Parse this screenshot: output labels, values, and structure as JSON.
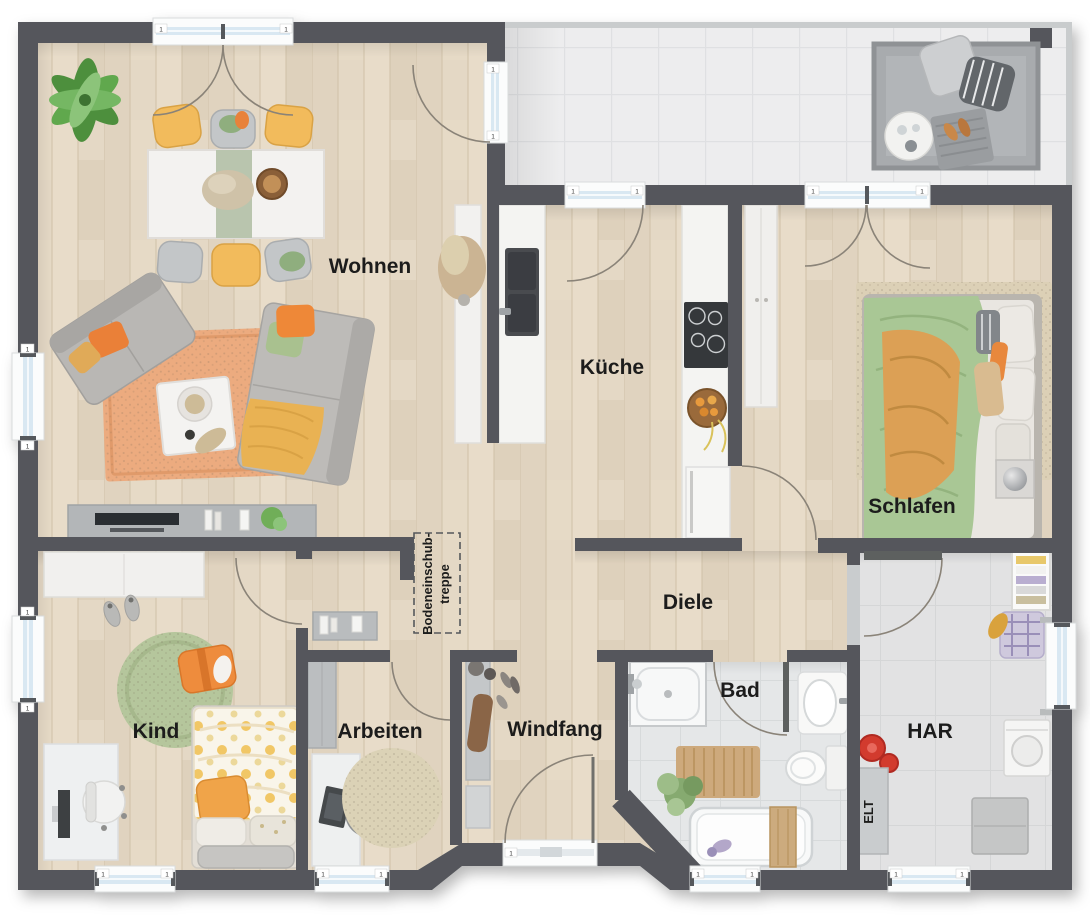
{
  "rooms": {
    "wohnen": {
      "label": "Wohnen"
    },
    "kueche": {
      "label": "Küche"
    },
    "schlafen": {
      "label": "Schlafen"
    },
    "diele": {
      "label": "Diele"
    },
    "kind": {
      "label": "Kind"
    },
    "arbeiten": {
      "label": "Arbeiten"
    },
    "windfang": {
      "label": "Windfang"
    },
    "bad": {
      "label": "Bad"
    },
    "har": {
      "label": "HAR"
    }
  },
  "annotations": {
    "attic_line1": "Bodeneinschub-",
    "attic_line2": "treppe",
    "elt": "ELT",
    "window_mark": "1"
  },
  "colors": {
    "wall": "#54575b",
    "floor_wood": "#e4d8c5",
    "tile_terrace": "#ededee",
    "tile_bath": "#e5e7e8",
    "tile_utility": "#e2e2e3",
    "door_glass": "#d9e8f2",
    "accent_orange": "#e8823a",
    "accent_green": "#a9c795",
    "accent_yellow": "#efb95a"
  }
}
